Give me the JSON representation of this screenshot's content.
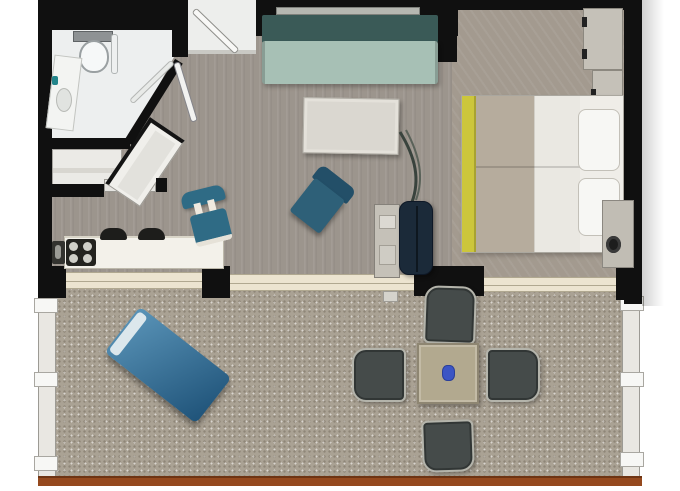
{
  "meta": {
    "type": "floor-plan",
    "description": "Top-down rendered floor plan of a studio suite with bathroom, entry, kitchenette, living area, bedroom and a furnished terrace"
  },
  "colors": {
    "wall": "#101010",
    "floor-living": "#9c958d",
    "floor-bedroom": "#a39a8f",
    "floor-terrace": "#aaa294",
    "bath-floor": "#edefef",
    "entry-floor": "#edeeec",
    "counter": "#f3f1ea",
    "track": "#ece4d0",
    "railing": "#e9e7e2",
    "railing-brown": "#95491e",
    "sofa-back": "#3a5a57",
    "sofa-seat": "#a7c0b5",
    "metal": "#b5b7b1",
    "coffee-table": "#dad7d0",
    "armchair": "#2e6078",
    "chair-blue": "#2f6b85",
    "lounger-a": "#5a94b8",
    "lounger-b": "#1f5379",
    "dining-chair": "#454b4a",
    "chair-frame": "#b4b4ab",
    "dining-table": "#b2a98f",
    "vase": "#3b55c5",
    "duvet": "#b6ac9d",
    "runner": "#ccc63c",
    "pillow": "#f7f7f4",
    "cabinet": "#c5c1b8",
    "tv": "#1b2a39",
    "stove": "#23231f",
    "accent-teal": "#23858b"
  },
  "rooms": [
    {
      "id": "bathroom",
      "fixtures": [
        "toilet",
        "sink",
        "shower-glass",
        "door"
      ]
    },
    {
      "id": "entry",
      "fixtures": [
        "entry-door"
      ]
    },
    {
      "id": "wardrobe-nook",
      "fixtures": [
        "closet-shelf",
        "angled-closet"
      ]
    },
    {
      "id": "kitchenette",
      "fixtures": [
        "counter",
        "stove",
        "sink-panel",
        "bar-stool",
        "bar-stool",
        "desk-chair"
      ]
    },
    {
      "id": "living-area",
      "fixtures": [
        "sofa",
        "coffee-table",
        "armchair",
        "plant",
        "media-cabinet",
        "tv-unit"
      ]
    },
    {
      "id": "bedroom",
      "fixtures": [
        "wardrobe",
        "wardrobe",
        "double-bed",
        "pillow",
        "pillow",
        "nightstand",
        "lamp"
      ]
    },
    {
      "id": "terrace",
      "fixtures": [
        "sun-lounger",
        "dining-table",
        "dining-chair",
        "dining-chair",
        "dining-chair",
        "dining-chair",
        "railing"
      ]
    }
  ]
}
